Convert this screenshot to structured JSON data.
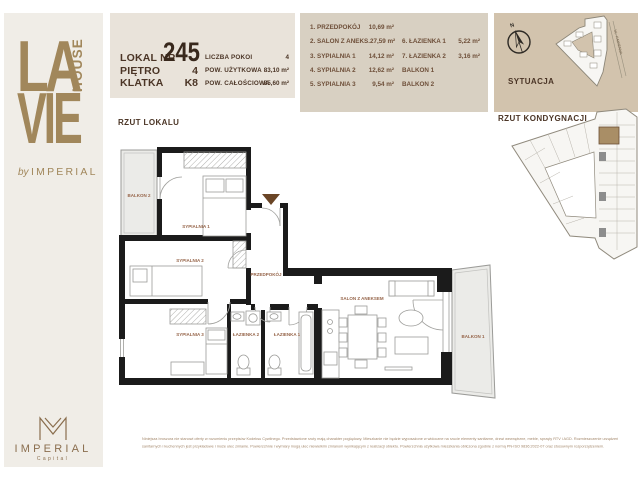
{
  "brand": {
    "word1": "LA",
    "word2": "VIE",
    "vertical": "HOUSE",
    "byline_prefix": "by",
    "byline_name": "IMPERIAL"
  },
  "unit_header": {
    "lokal_label": "LOKAL NR",
    "lokal_number": "245",
    "floor_label": "PIĘTRO",
    "floor_value": "4",
    "staircase_label": "KLATKA",
    "staircase_value": "K8",
    "rooms_count_label": "LICZBA POKOI",
    "rooms_count_value": "4",
    "usable_area_label": "POW. UŻYTKOWA",
    "usable_area_value": "83,10 m²",
    "total_area_label": "POW. CAŁOŚCIOWA",
    "total_area_value": "85,60 m²"
  },
  "room_list": {
    "col1": [
      {
        "name": "1. PRZEDPOKÓJ",
        "area": "10,69 m²"
      },
      {
        "name": "2. SALON Z ANEKS.",
        "area": "27,59 m²"
      },
      {
        "name": "3. SYPIALNIA 1",
        "area": "14,12 m²"
      },
      {
        "name": "4. SYPIALNIA 2",
        "area": "12,62 m²"
      },
      {
        "name": "5. SYPIALNIA 3",
        "area": "9,54 m²"
      }
    ],
    "col2": [
      {
        "name": "6. ŁAZIENKA 1",
        "area": "5,22 m²"
      },
      {
        "name": "7. ŁAZIENKA 2",
        "area": "3,16 m²"
      },
      {
        "name": "BALKON 1",
        "area": ""
      },
      {
        "name": "BALKON 2",
        "area": ""
      }
    ]
  },
  "situation": {
    "title": "SYTUACJA",
    "north_label": "N",
    "street_label": "UL. KAMIENNA"
  },
  "unit_plan": {
    "title": "RZUT LOKALU",
    "rooms": {
      "balkon2": "BALKON 2",
      "sypialnia1": "SYPIALNIA 1",
      "sypialnia2": "SYPIALNIA 2",
      "sypialnia3": "SYPIALNIA 3",
      "przedpokoj": "PRZEDPOKÓJ",
      "lazienka2": "ŁAZIENKA 2",
      "lazienka1": "ŁAZIENKA 1",
      "salon": "SALON Z ANEKSEM",
      "balkon1": "BALKON 1"
    }
  },
  "floor_plan": {
    "title": "RZUT KONDYGNACJI"
  },
  "footer": {
    "developer_name": "IMPERIAL",
    "developer_sub": "Capital",
    "disclaimer_line1": "Niniejsza broszura nie stanowi oferty w rozumieniu przepisów Kodeksu Cywilnego. Przedstawione rzuty mają charakter poglądowy. Mieszkanie nie będzie wyposażone w widoczne na rzucie elementy sanitarne, drzwi wewnętrzne, meble, sprzęty RTV i AGD. Rozmieszczenie urządzeń",
    "disclaimer_line2": "sanitarnych i kuchennych jest przykładowe i może ulec zmianie. Powierzchnie i wymiary mogą ulec niewielkim zmianom wynikającym z realizacji obiektu. Powierzchnia użytkowa mieszkania obliczona zgodnie z normą PN-ISO 9836:2022-07 oraz stosownym rozporządzeniem."
  },
  "colors": {
    "brand_gold": "#a1875b",
    "heading_brown": "#4b3526",
    "list_text_brown": "#6e4f39",
    "plan_label_brown": "#96654a",
    "panel_light": "#f0ede7",
    "panel_header": "#e9e3da",
    "panel_list": "#d8d0c2",
    "panel_situation": "#d2c3ad",
    "wall_black": "#1b1b1b",
    "entry_arrow_brown": "#6a4526",
    "highlight_unit_tan": "#a98e66"
  }
}
